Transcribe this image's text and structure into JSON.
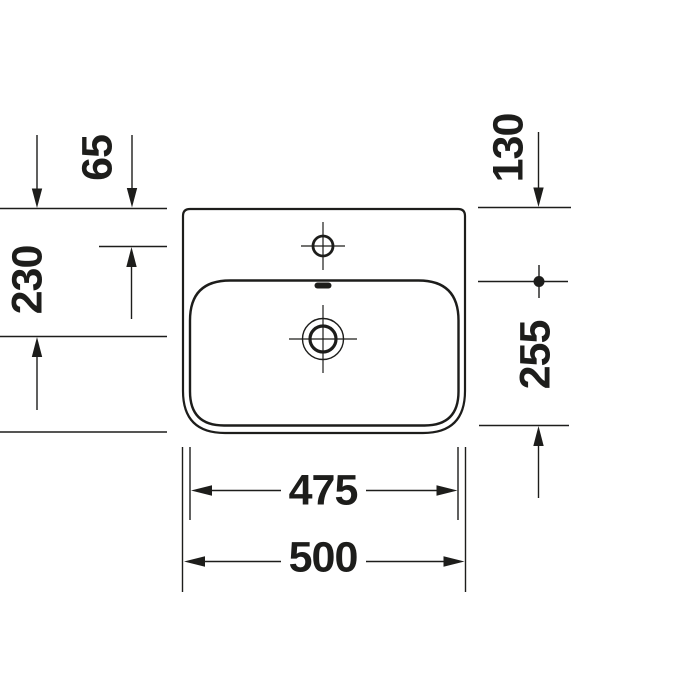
{
  "drawing": {
    "subject": "washbasin-top-view-technical-drawing",
    "colors": {
      "line": "#1d1d1b",
      "background": "#ffffff"
    },
    "dimensions": {
      "faucet_center_from_top_edge": "65",
      "drain_center_from_top_edge": "230",
      "inner_edge_from_top_edge": "130",
      "bowl_depth_span": "255",
      "bowl_inner_width": "475",
      "overall_width": "500"
    }
  }
}
